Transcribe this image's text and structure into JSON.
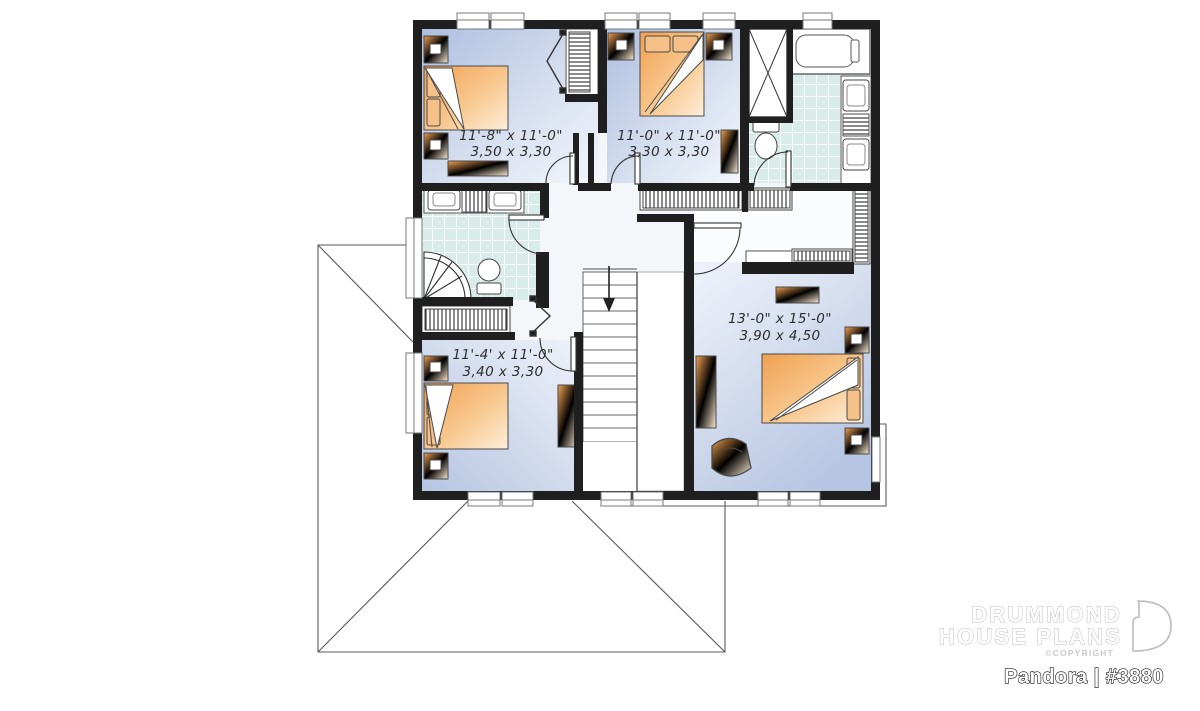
{
  "branding": {
    "company_line1": "DRUMMOND",
    "company_line2": "HOUSE PLANS",
    "copyright_label": "©COPYRIGHT",
    "plan_title": "Pandora | #3880"
  },
  "floor_plan": {
    "rooms": [
      {
        "name": "bedroom-top-left",
        "imperial": "11'-8\" x 11'-0\"",
        "metric": "3,50 x 3,30"
      },
      {
        "name": "bedroom-top-center",
        "imperial": "11'-0\" x 11'-0\"",
        "metric": "3,30 x 3,30"
      },
      {
        "name": "master-bedroom",
        "imperial": "13'-0\" x 15'-0\"",
        "metric": "3,90 x 4,50"
      },
      {
        "name": "bedroom-bottom-left",
        "imperial": "11'-4' x 11'-0\"",
        "metric": "3,40 x 3,30"
      }
    ],
    "colors": {
      "wall": "#1f1f1f",
      "floor_blue_dark": "#b3c3e0",
      "floor_blue_light": "#f2f5fb",
      "tile_teal": "#d9ece9",
      "furniture_orange": "#f2a55c",
      "label_text": "#2d2d2d"
    }
  }
}
